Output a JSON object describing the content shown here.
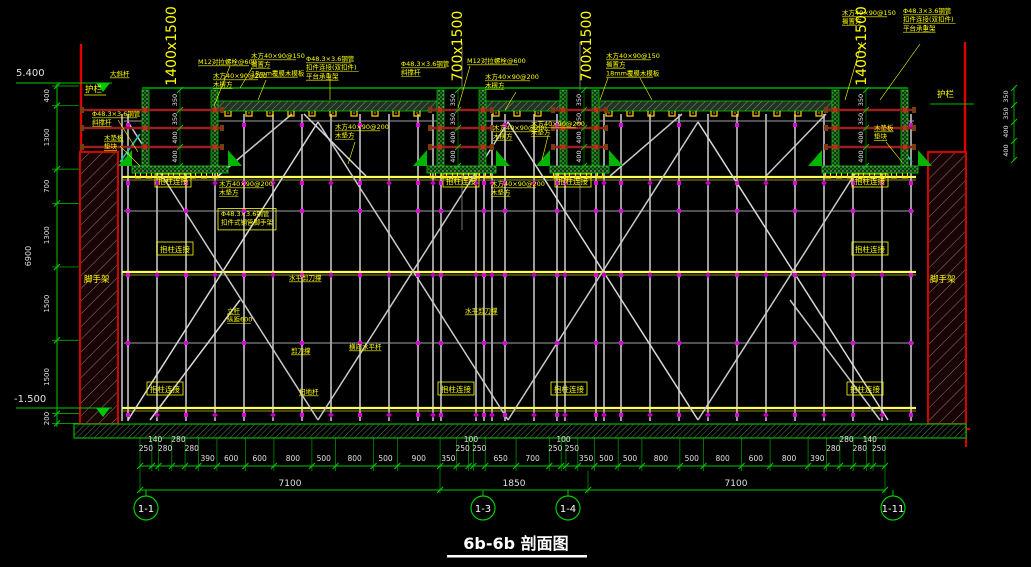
{
  "drawing": {
    "title": "6b-6b 剖面图",
    "elevation_top": "5.400",
    "elevation_bottom": "-1.500",
    "guardrail_left": "护栏",
    "guardrail_right": "护栏",
    "wall_label_left": "脚手架",
    "wall_label_right": "脚手架",
    "beam_size_labels": [
      "1400x1500",
      "700x1500",
      "700x1500",
      "1400x1500"
    ],
    "beam_depth_dims": [
      "350",
      "350",
      "400",
      "400"
    ],
    "right_edge_dims": [
      "350",
      "350",
      "400",
      "400"
    ],
    "left_dim_chain": [
      "400",
      "1300",
      "700",
      "1300",
      "1500",
      "1500",
      "200"
    ],
    "left_dim_total": "6900",
    "grid_bubbles": [
      "1-1",
      "1-3",
      "1-4",
      "1-11"
    ],
    "bottom_dim_chain": [
      "250",
      "140",
      "280",
      "280",
      "280",
      "390",
      "600",
      "600",
      "800",
      "500",
      "800",
      "500",
      "900",
      "350",
      "250",
      "100",
      "250",
      "650",
      "700",
      "250",
      "100",
      "250",
      "350",
      "500",
      "500",
      "800",
      "500",
      "800",
      "600",
      "800",
      "390",
      "280",
      "280",
      "280",
      "140",
      "250"
    ],
    "bottom_dim_totals": [
      "7100",
      "1850",
      "7100"
    ],
    "ann": {
      "a_m12": "M12对拉螺栓@600",
      "a_joist1": "木方40×90@150",
      "a_joist2": "搁置方",
      "a_joist3": "18mm覆膜木模板",
      "a_tube1": "Φ48.3×3.6钢管",
      "a_tube2": "扣件连接(双扣件)",
      "a_tube3": "平台承重架",
      "a_sec1": "木方40×90@200",
      "a_sec2": "木楞方",
      "a_pad2": "木垫方",
      "a_diag2": "斜撑杆",
      "a_daxg": "大斜杆",
      "a_wpad1": "木垫板",
      "a_wpad2": "垫块",
      "a_clamp": "抱柱连接",
      "a_frame2": "扣件式钢管脚手架",
      "a_hshear": "水平剪刀撑",
      "a_post1": "立杆",
      "a_post2": "纵距600",
      "a_shear": "剪刀撑",
      "a_hbar": "横向水平杆",
      "a_sweep": "扫地杆"
    },
    "colors": {
      "background": "#000000",
      "dim_green": "#00c800",
      "wall_red": "#d40000",
      "tie_rod_red": "#9c1f1f",
      "label_yellow": "#ffff00",
      "runner_yellow": "#ffff55",
      "scaffold_gray": "#b8b8b8",
      "marker_magenta": "#e000e0",
      "text_white": "#e8e8e8"
    }
  }
}
